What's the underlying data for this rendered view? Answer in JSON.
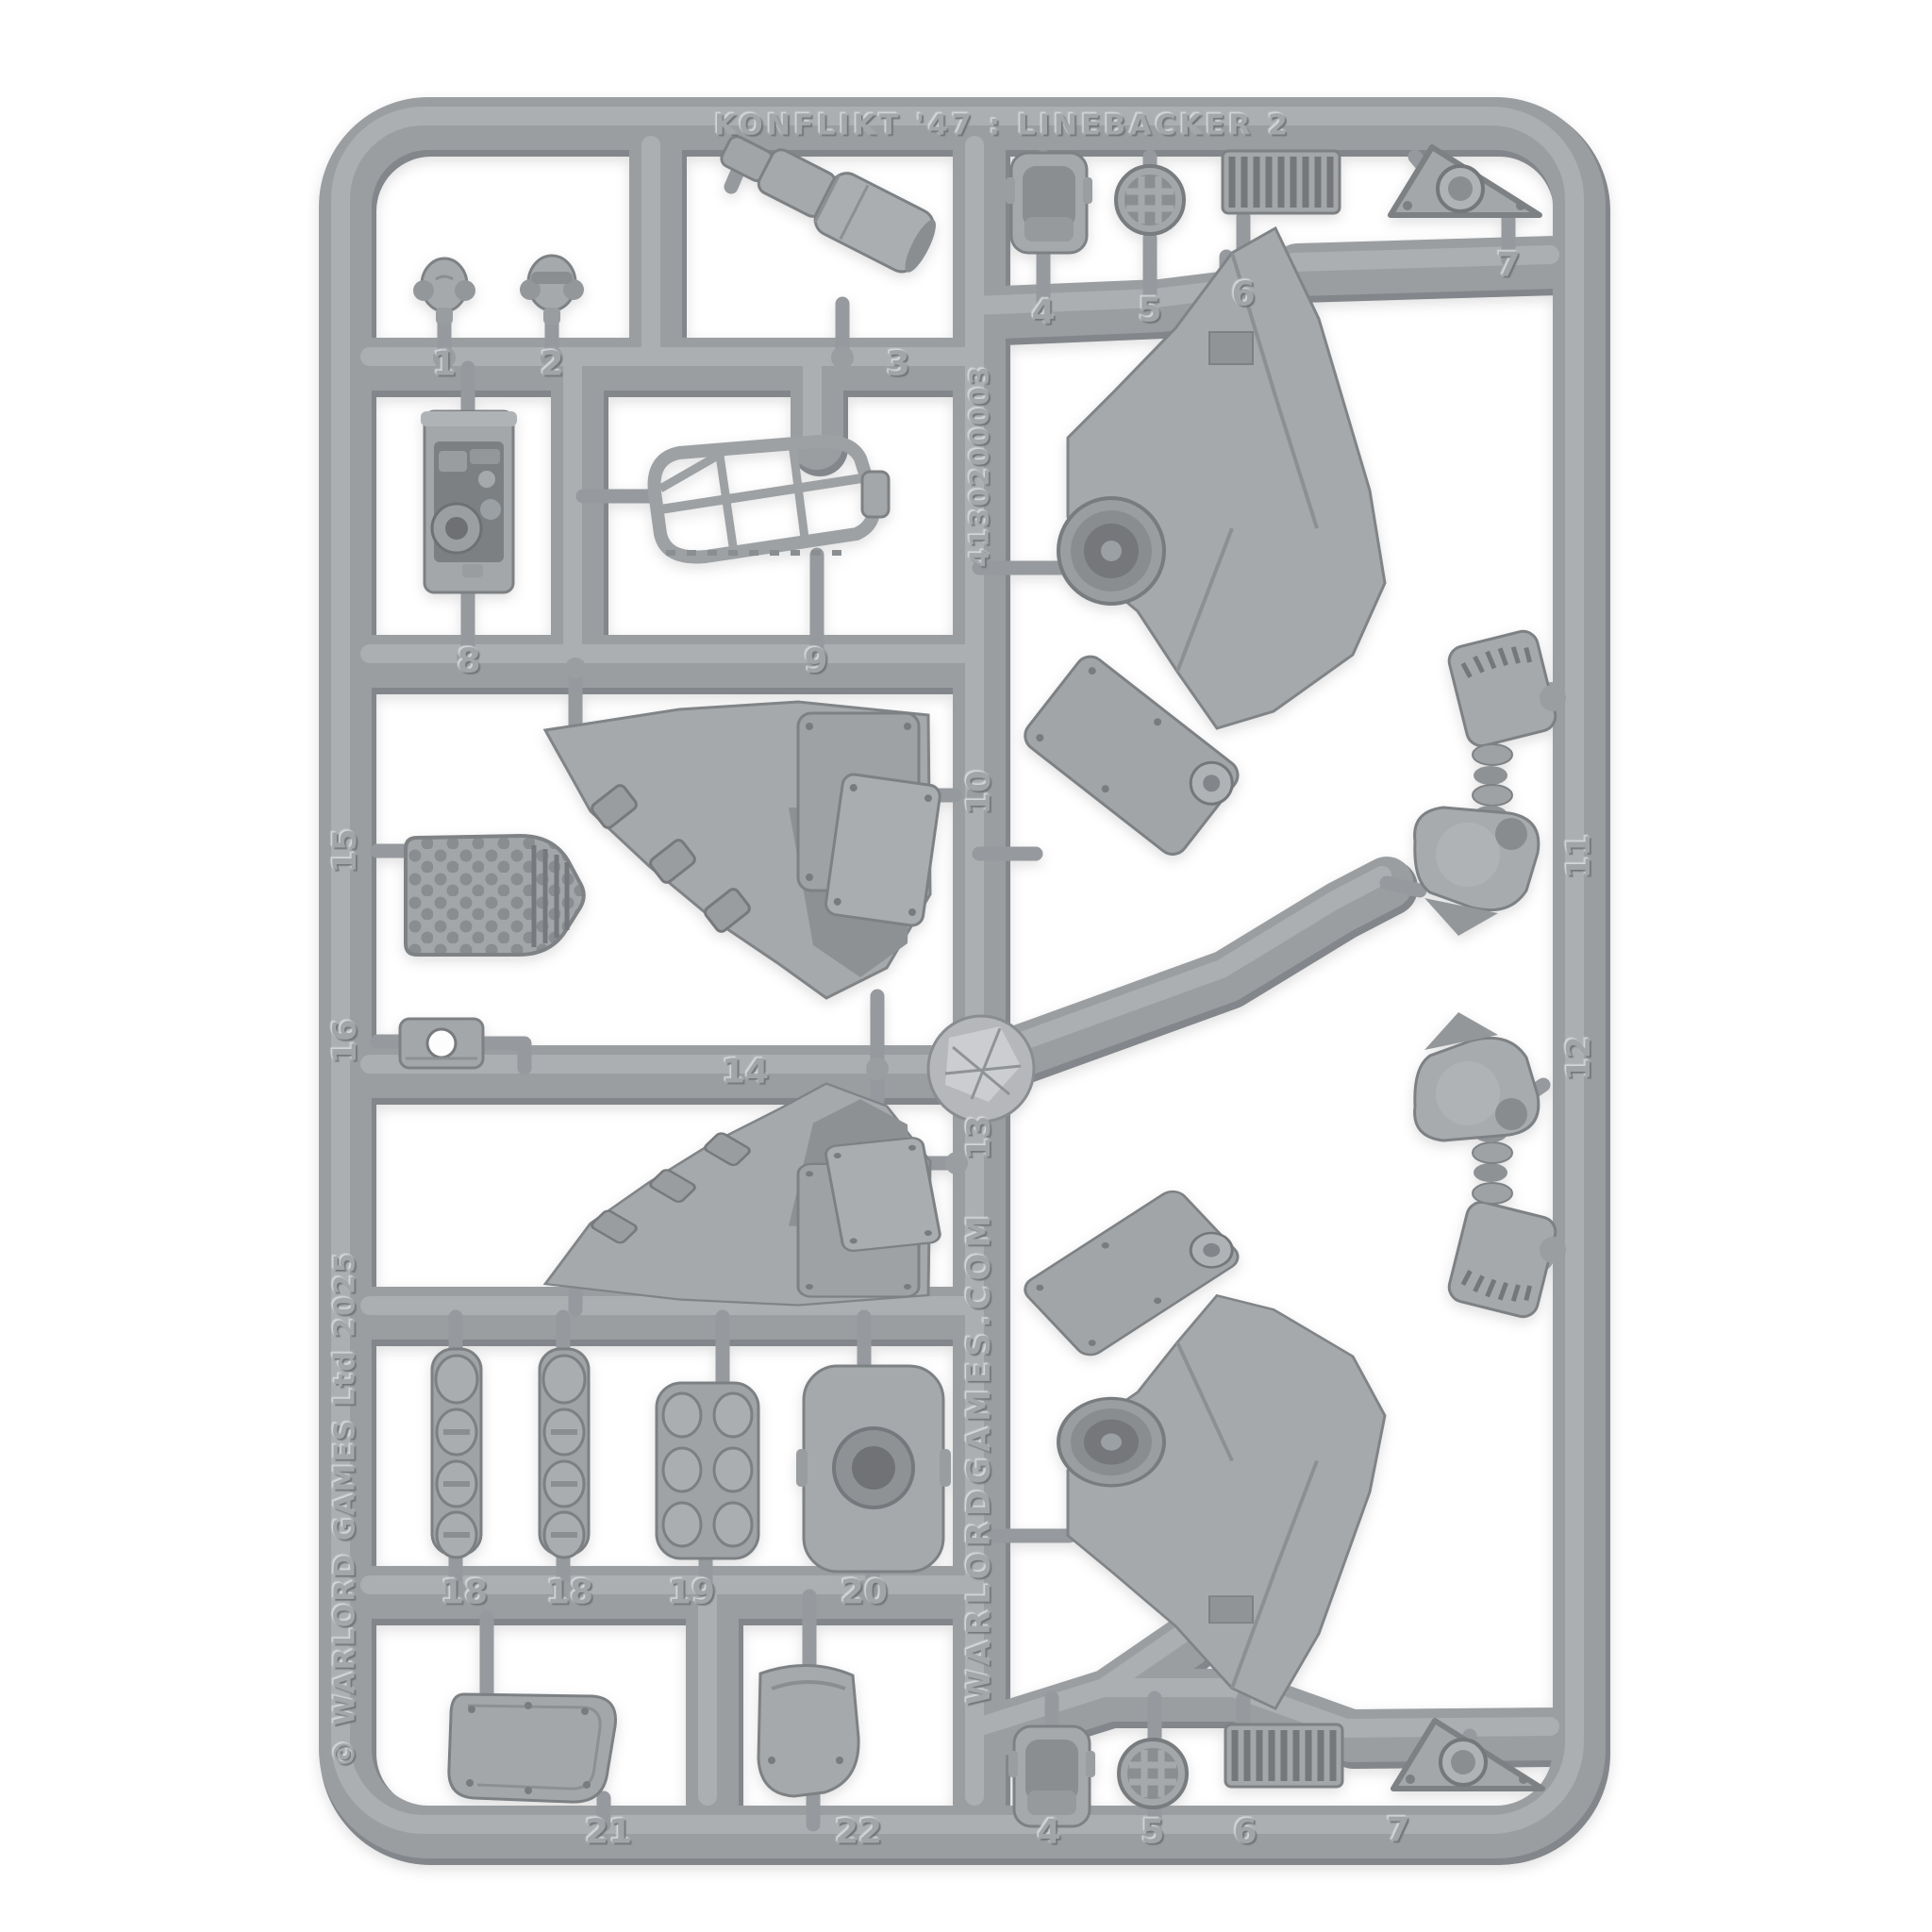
{
  "photo": {
    "subject": "grey-plastic-model-sprue",
    "background_color": "#ffffff",
    "plastic_color": "#9b9ea1",
    "plastic_highlight": "#b4b6b9",
    "plastic_shadow": "#83868a"
  },
  "embossed": {
    "title": "KONFLIKT '47 : LINEBACKER 2",
    "product_code": "4130200003",
    "website": "WARLORDGAMES.COM",
    "copyright": "© WARLORD GAMES Ltd 2025"
  },
  "part_numbers": {
    "p1": "1",
    "p2": "2",
    "p3": "3",
    "p4": "4",
    "p5": "5",
    "p6": "6",
    "p7": "7",
    "p8": "8",
    "p9": "9",
    "p10": "10",
    "p11": "11",
    "p12": "12",
    "p13": "13",
    "p14": "14",
    "p15": "15",
    "p16": "16",
    "p18": "18",
    "p19": "19",
    "p20": "20",
    "p21": "21",
    "p22": "22"
  }
}
